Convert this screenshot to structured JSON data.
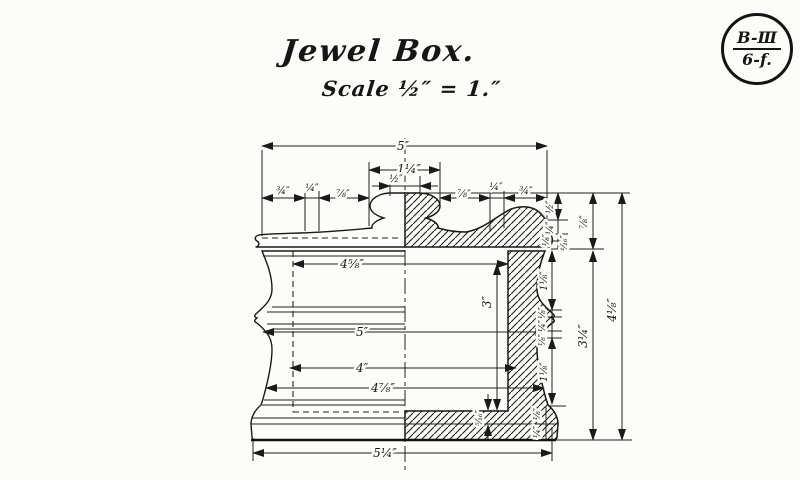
{
  "title": "Jewel Box.",
  "scale_label": "Scale ½″ = 1.″",
  "badge": {
    "top": "B-Ⅲ",
    "bottom": "6-f."
  },
  "dims": {
    "top_width": "5″",
    "knob_width": "1¼″",
    "knob_top_width": "½″",
    "lid_left_a": "¾″",
    "lid_left_b": "¼″",
    "lid_left_c": "⅞″",
    "lid_right_a": "⅞″",
    "lid_right_b": "¼″",
    "lid_right_c": "¾″",
    "inner_top_width": "4⅝″",
    "inner_depth": "3″",
    "mid_width": "5″",
    "inner_bottom_width": "4″",
    "lower_width": "4⅞″",
    "base_width": "5¼″",
    "floor_thickness": "⁵⁄₁₆″",
    "lid_steps": [
      "½″",
      "¼″",
      "⅛″",
      "¹⁄₁₆″"
    ],
    "body_steps": [
      "1⅛″",
      "⅛″",
      "¼″",
      "⅛″",
      "1⅛″",
      "⅛″",
      "¼″"
    ],
    "lid_height": "⅞″",
    "body_height": "3¼″",
    "overall_height": "4⅛″"
  }
}
